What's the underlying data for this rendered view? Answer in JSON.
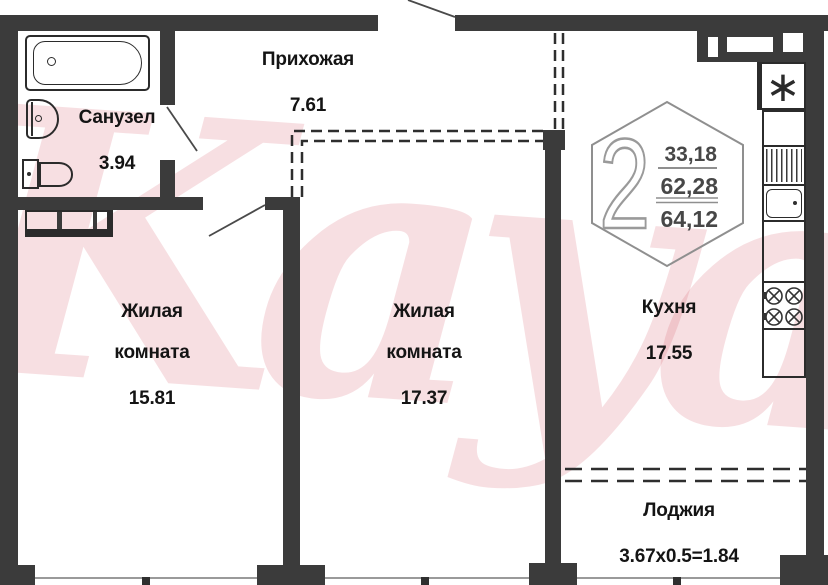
{
  "plan": {
    "watermark": "Kayan",
    "badge": {
      "room_count": "2",
      "area_living": "33,18",
      "area_total": "62,28",
      "area_total_with_loggia": "64,12"
    },
    "rooms": {
      "sanuzel": {
        "name": "Санузел",
        "area": "3.94"
      },
      "prihozhaya": {
        "name": "Прихожая",
        "area": "7.61"
      },
      "living1": {
        "name": "Жилая комната",
        "area": "15.81"
      },
      "living2": {
        "name": "Жилая комната",
        "area": "17.37"
      },
      "kitchen": {
        "name": "Кухня",
        "area": "17.55"
      },
      "loggia": {
        "name": "Лоджия",
        "area": "3.67x0.5=1.84"
      }
    },
    "symbols": {
      "vent_shaft": "∗"
    }
  }
}
